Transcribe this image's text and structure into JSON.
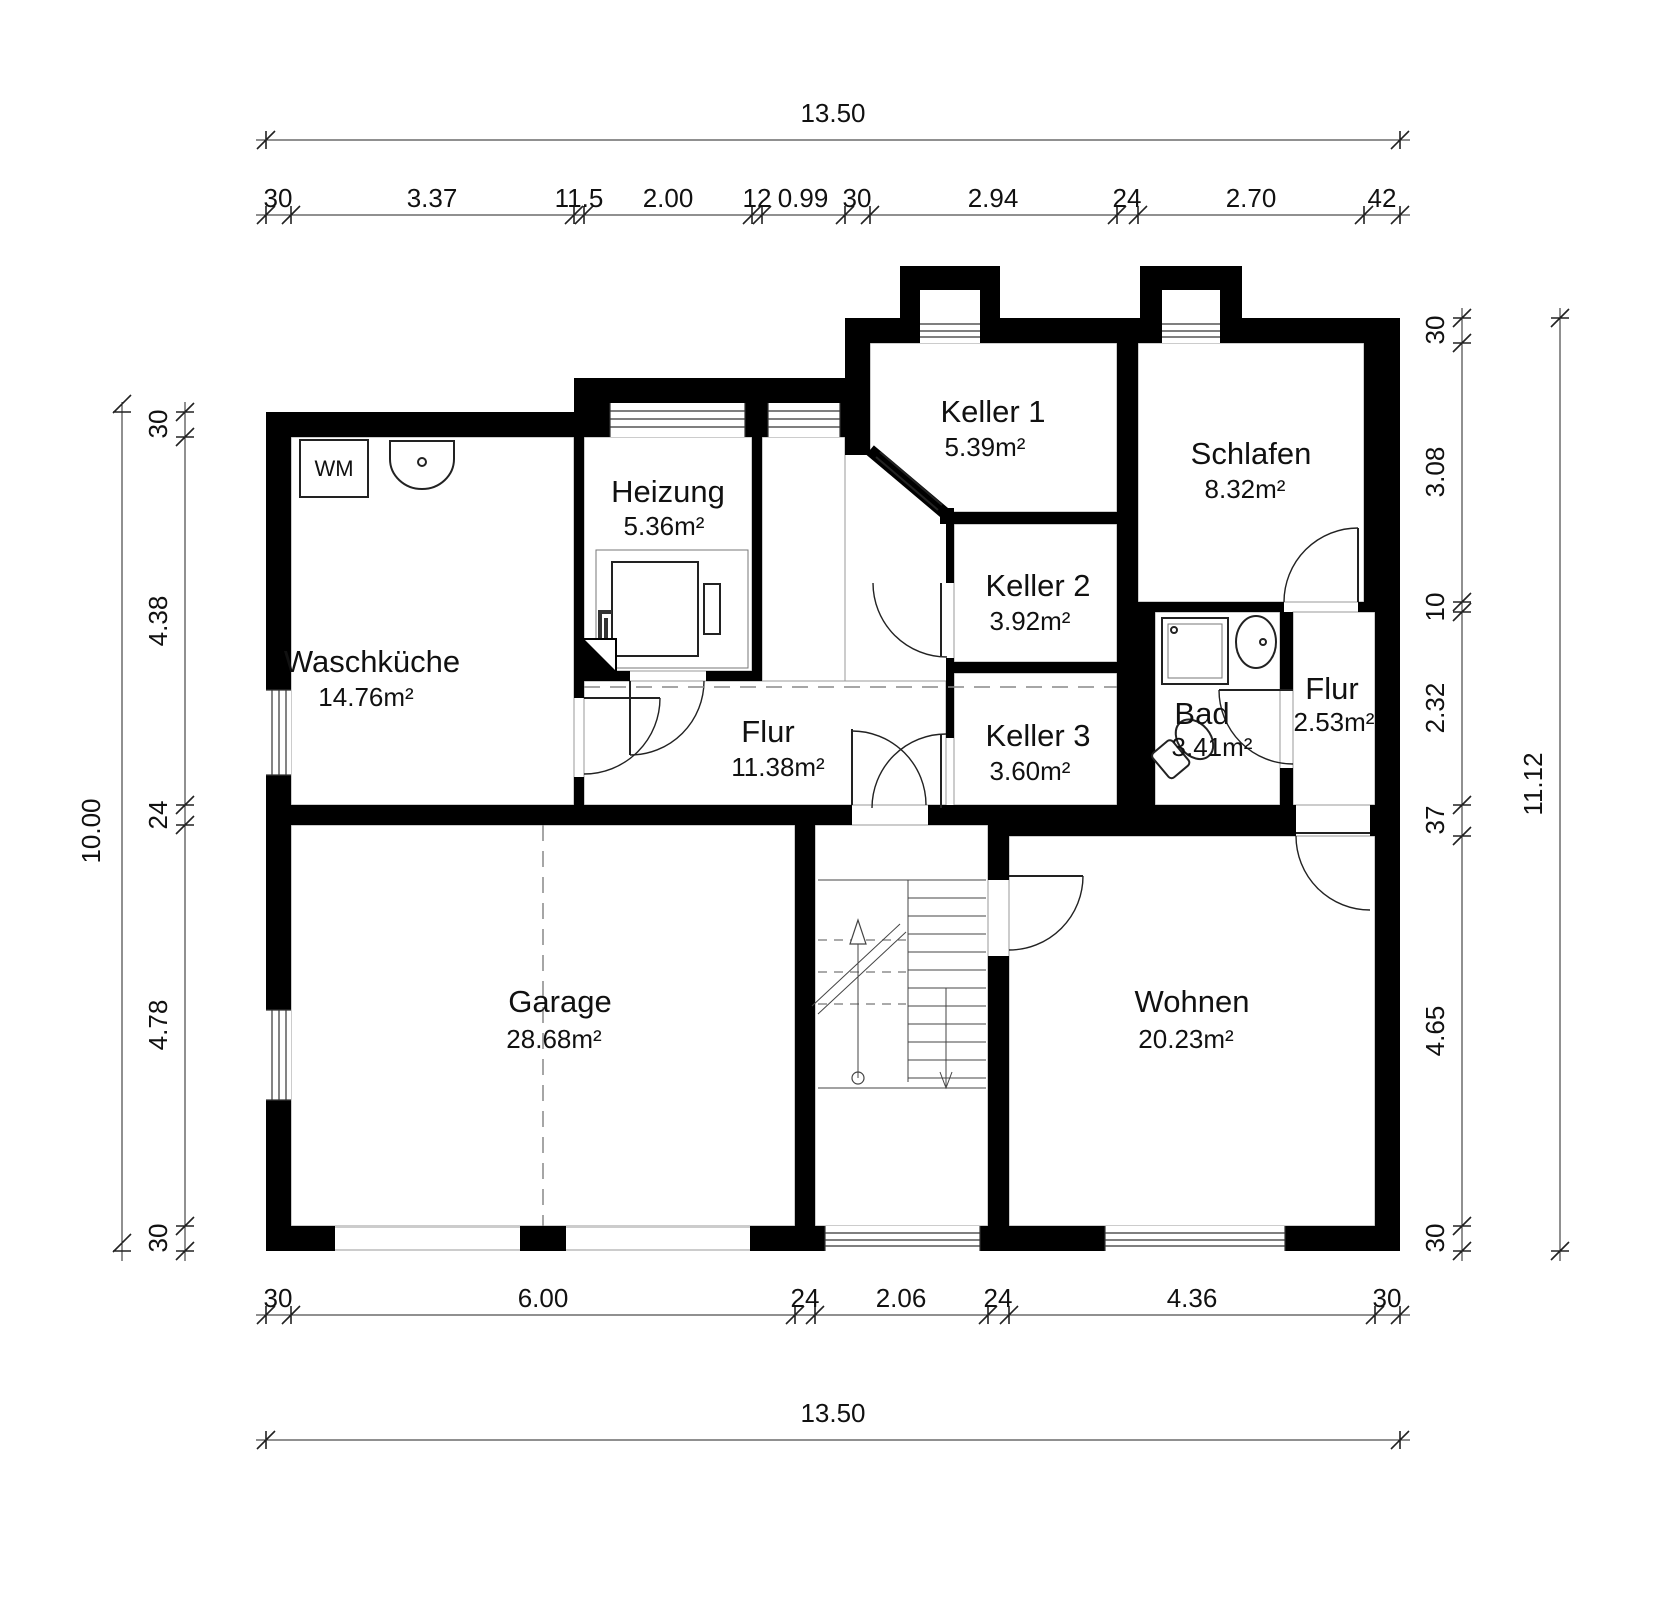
{
  "plan": {
    "labels": {
      "wm": "WM"
    },
    "rooms": [
      {
        "id": "waschkueche",
        "name": "Waschküche",
        "area": "14.76m²"
      },
      {
        "id": "heizung",
        "name": "Heizung",
        "area": "5.36m²"
      },
      {
        "id": "keller1",
        "name": "Keller 1",
        "area": "5.39m²"
      },
      {
        "id": "keller2",
        "name": "Keller 2",
        "area": "3.92m²"
      },
      {
        "id": "keller3",
        "name": "Keller 3",
        "area": "3.60m²"
      },
      {
        "id": "schlafen",
        "name": "Schlafen",
        "area": "8.32m²"
      },
      {
        "id": "bad",
        "name": "Bad",
        "area": "3.41m²"
      },
      {
        "id": "flur-klein",
        "name": "Flur",
        "area": "2.53m²"
      },
      {
        "id": "flur",
        "name": "Flur",
        "area": "11.38m²"
      },
      {
        "id": "garage",
        "name": "Garage",
        "area": "28.68m²"
      },
      {
        "id": "wohnen",
        "name": "Wohnen",
        "area": "20.23m²"
      }
    ],
    "dimensions": {
      "top_total": "13.50",
      "bottom_total": "13.50",
      "left_total": "10.00",
      "right_total": "11.12",
      "top_chain": [
        "30",
        "3.37",
        "11.5",
        "2.00",
        "12",
        "0.99",
        "30",
        "2.94",
        "24",
        "2.70",
        "42"
      ],
      "bottom_chain": [
        "30",
        "6.00",
        "24",
        "2.06",
        "24",
        "4.36",
        "30"
      ],
      "left_chain": [
        "30",
        "4.38",
        "24",
        "4.78",
        "30"
      ],
      "right_chain": [
        "30",
        "3.08",
        "10",
        "2.32",
        "37",
        "4.65",
        "30"
      ]
    },
    "colors": {
      "wall": "#000000",
      "line": "#222222",
      "dashed": "#888888"
    }
  }
}
